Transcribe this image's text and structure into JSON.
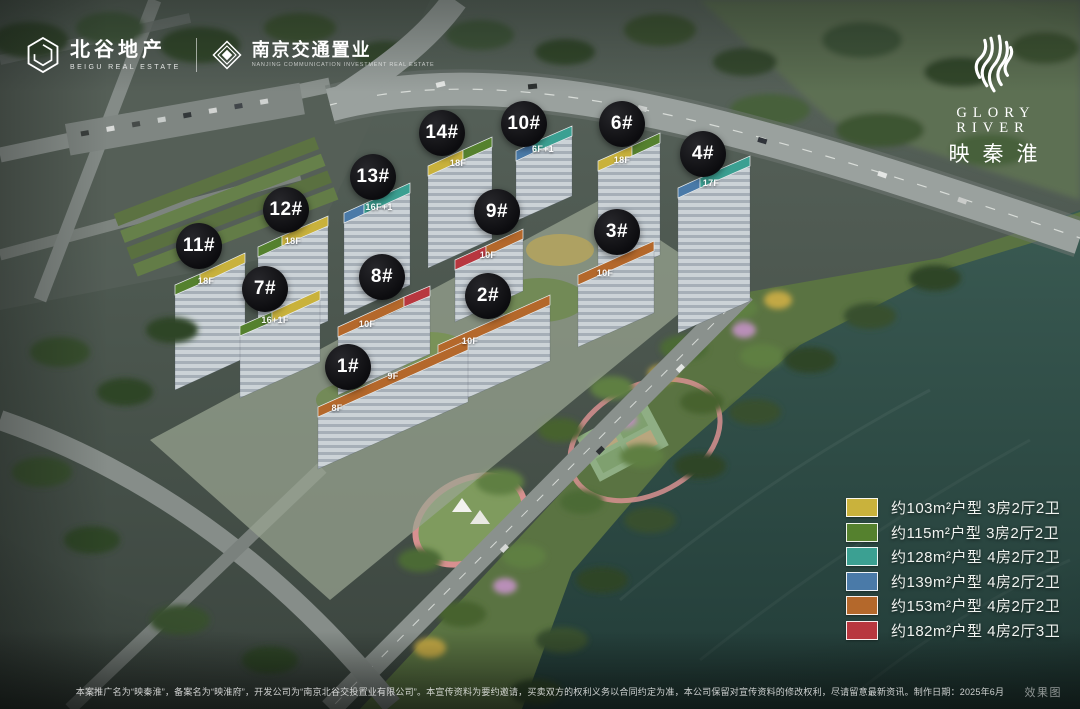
{
  "branding": {
    "beigu": {
      "name_cn": "北谷地产",
      "name_en": "BEIGU REAL ESTATE"
    },
    "partner": {
      "name_cn": "南京交通置业",
      "name_en": "NANJING COMMUNICATION INVESTMENT REAL ESTATE"
    },
    "project": {
      "name_en": "GLORY RIVER",
      "name_cn": "映秦淮"
    }
  },
  "buildings": {
    "badges": [
      {
        "label": "1#",
        "x": 348,
        "y": 367
      },
      {
        "label": "2#",
        "x": 488,
        "y": 296
      },
      {
        "label": "3#",
        "x": 617,
        "y": 232
      },
      {
        "label": "4#",
        "x": 703,
        "y": 154
      },
      {
        "label": "6#",
        "x": 622,
        "y": 124
      },
      {
        "label": "7#",
        "x": 265,
        "y": 289
      },
      {
        "label": "8#",
        "x": 382,
        "y": 277
      },
      {
        "label": "9#",
        "x": 497,
        "y": 212
      },
      {
        "label": "10#",
        "x": 524,
        "y": 124
      },
      {
        "label": "11#",
        "x": 199,
        "y": 246
      },
      {
        "label": "12#",
        "x": 286,
        "y": 210
      },
      {
        "label": "13#",
        "x": 373,
        "y": 177
      },
      {
        "label": "14#",
        "x": 442,
        "y": 133
      }
    ],
    "roof_labels": [
      {
        "text": "18F",
        "x": 206,
        "y": 281
      },
      {
        "text": "18F",
        "x": 293,
        "y": 241
      },
      {
        "text": "16F+1",
        "x": 379,
        "y": 207
      },
      {
        "text": "18F",
        "x": 458,
        "y": 163
      },
      {
        "text": "6F+1",
        "x": 543,
        "y": 149
      },
      {
        "text": "18F",
        "x": 622,
        "y": 160
      },
      {
        "text": "17F",
        "x": 711,
        "y": 183
      },
      {
        "text": "10F",
        "x": 605,
        "y": 273
      },
      {
        "text": "16+1F",
        "x": 275,
        "y": 320
      },
      {
        "text": "10F",
        "x": 367,
        "y": 324
      },
      {
        "text": "10F",
        "x": 488,
        "y": 255
      },
      {
        "text": "10F",
        "x": 470,
        "y": 341
      },
      {
        "text": "9F",
        "x": 393,
        "y": 376
      },
      {
        "text": "8F",
        "x": 337,
        "y": 408
      }
    ]
  },
  "legend": {
    "items": [
      {
        "color": "#c9b23c",
        "label": "约103m²户型 3房2厅2卫"
      },
      {
        "color": "#55812e",
        "label": "约115m²户型 3房2厅2卫"
      },
      {
        "color": "#3ba092",
        "label": "约128m²户型 4房2厅2卫"
      },
      {
        "color": "#4a7aa8",
        "label": "约139m²户型 4房2厅2卫"
      },
      {
        "color": "#b4682b",
        "label": "约153m²户型 4房2厅2卫"
      },
      {
        "color": "#b8373f",
        "label": "约182m²户型 4房2厅3卫"
      }
    ]
  },
  "footer": {
    "disclaimer": "本案推广名为“映秦淮”，备案名为“映淮府”，开发公司为“南京北谷交投置业有限公司”。本宣传资料为要约邀请，买卖双方的权利义务以合同约定为准，本公司保留对宣传资料的修改权利，尽请留意最新资讯。制作日期：2025年6月",
    "watermark": "效果图"
  }
}
